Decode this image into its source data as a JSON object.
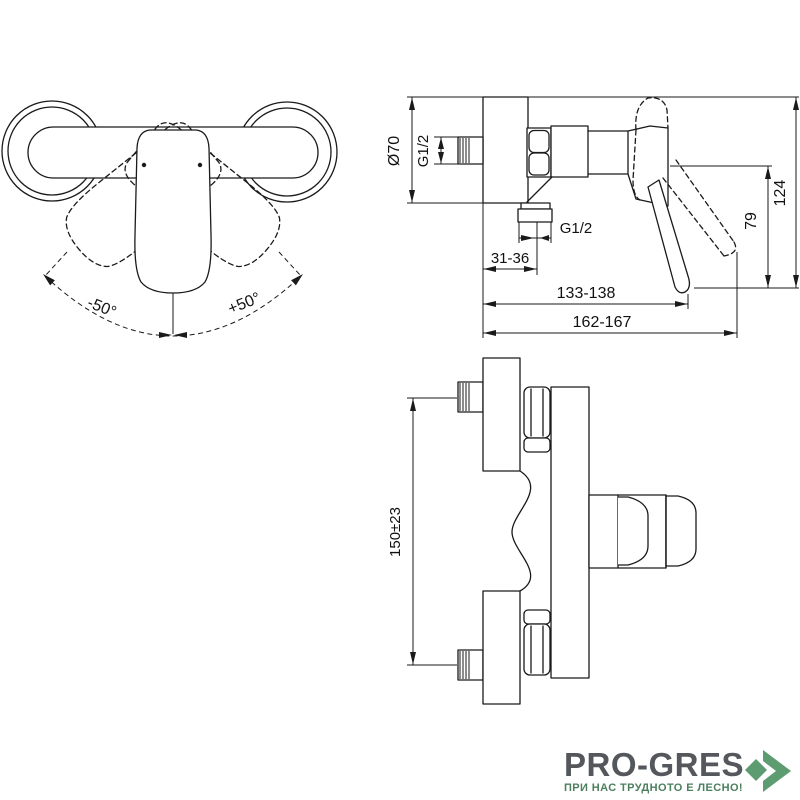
{
  "page": {
    "background": "#ffffff",
    "line_color": "#1a1a1a"
  },
  "top_view": {
    "rotation_left": "-50°",
    "rotation_right": "+50°"
  },
  "side_view": {
    "flange_diameter": "Ø70",
    "inlet_thread": "G1/2",
    "outlet_thread": "G1/2",
    "wall_to_outlet": "31-36",
    "wall_to_handle_tip": "133-138",
    "overall_depth": "162-167",
    "handle_height": "79",
    "overall_height": "124"
  },
  "front_view": {
    "connection_centers": "150±23"
  },
  "logo": {
    "brand": "PRO-GRES",
    "tagline": "ПРИ НАС ТРУДНОТО Е ЛЕСНО!",
    "brand_color": "#54575b",
    "tagline_color": "#4c7f5e",
    "arrow_color": "#5d9b70"
  }
}
